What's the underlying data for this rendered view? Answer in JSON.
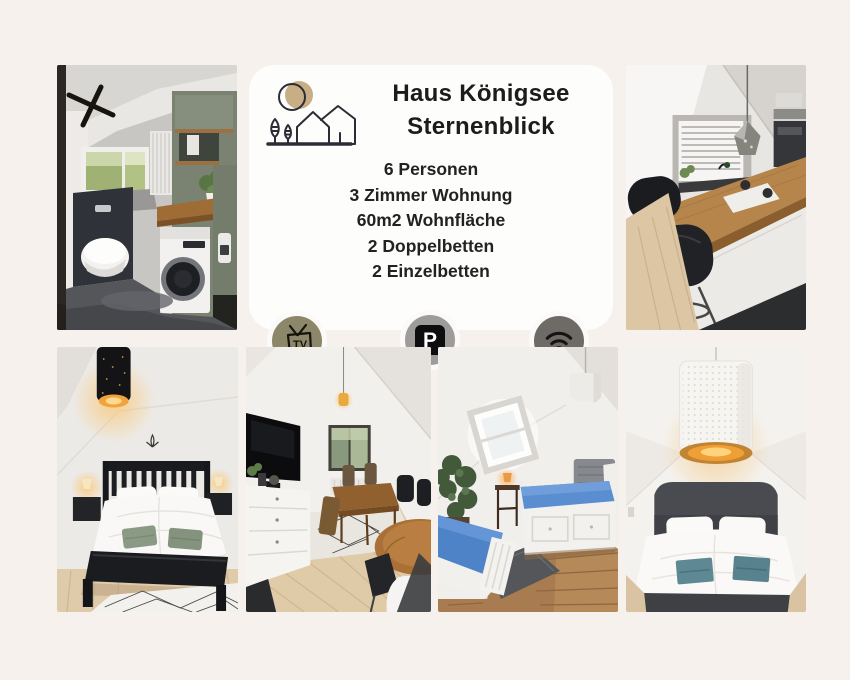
{
  "page": {
    "background": "#f7f1ed",
    "card_background": "#fdfdfc"
  },
  "card": {
    "logo_icon": "house-sun-trees-logo",
    "title_line1": "Haus Königsee",
    "title_line2": "Sternenblick",
    "details": [
      "6 Personen",
      "3 Zimmer Wohnung",
      "60m2 Wohnfläche",
      "2 Doppelbetten",
      "2 Einzelbetten"
    ]
  },
  "badges": {
    "tv": {
      "label": "TV",
      "color": "#8d8769"
    },
    "parking": {
      "label": "P",
      "color": "#9d9c9a"
    },
    "wifi": {
      "color": "#6e6a66"
    }
  },
  "photos": {
    "bathroom": {
      "description": "Bathroom with washing machine, wooden counter and sage green cabinets"
    },
    "kitchen": {
      "description": "Attic kitchen with wooden breakfast bar, black chairs and pendant lamp"
    },
    "bedroom_black_bed": {
      "description": "Bedroom with black wooden double bed and glowing bedside lamps"
    },
    "living_dining": {
      "description": "Living and dining room with TV sideboard and wooden dining table"
    },
    "single_beds_room": {
      "description": "Attic room with two single day beds with blue mattresses and skylight"
    },
    "bedroom_grey_bed": {
      "description": "Bedroom with grey double bed and white perforated pendant lamp"
    }
  }
}
